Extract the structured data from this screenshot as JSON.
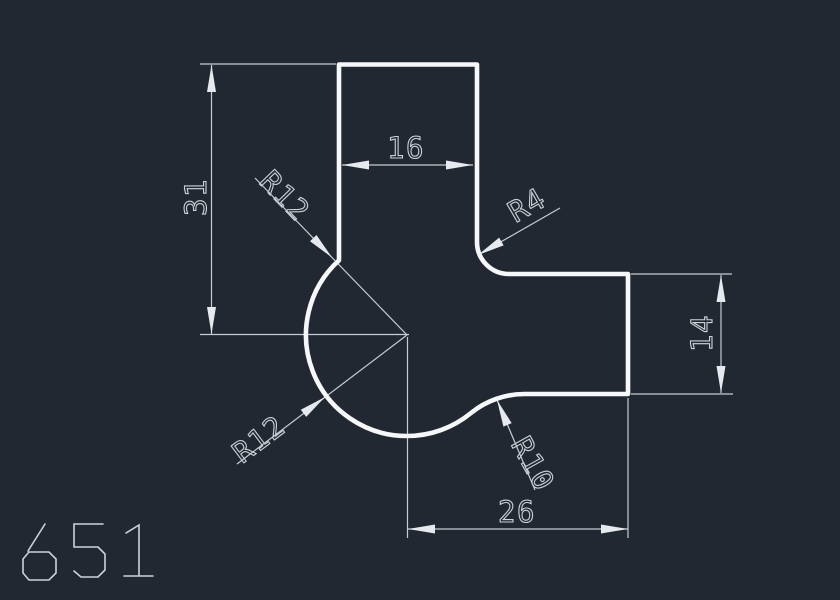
{
  "canvas": {
    "background": "#222831",
    "profile_color": "#f5f7f9",
    "dim_color": "#c6ccd4",
    "text_color": "#ccd2da"
  },
  "part_number": "651",
  "dimensions": {
    "d31": {
      "label": "31"
    },
    "d16": {
      "label": "16"
    },
    "d14": {
      "label": "14"
    },
    "d26": {
      "label": "26"
    },
    "r12_upper": {
      "label": "R12"
    },
    "r4": {
      "label": "R4"
    },
    "r10": {
      "label": "R10"
    },
    "r12_lower": {
      "label": "R12"
    }
  }
}
